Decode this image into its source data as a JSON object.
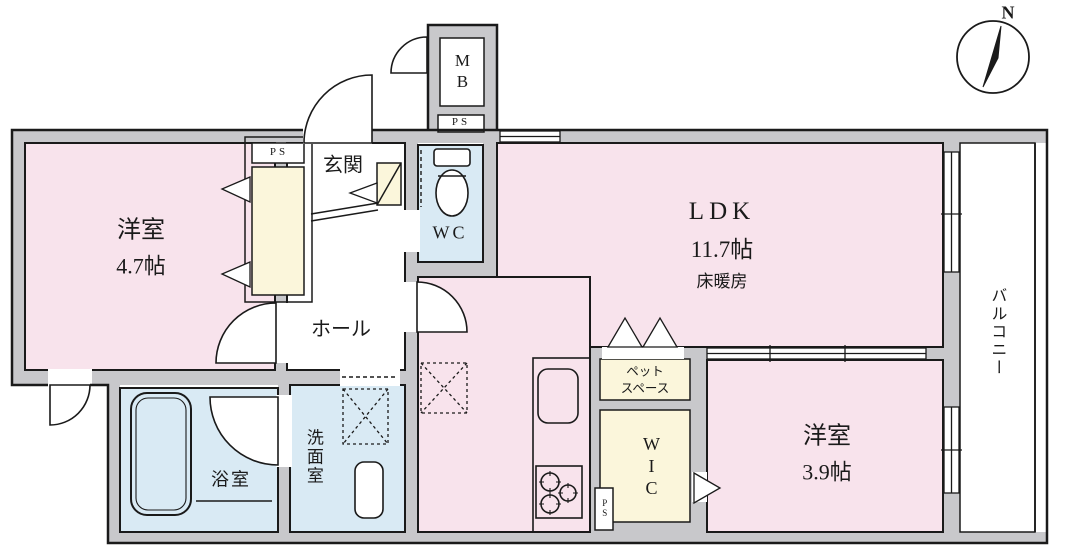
{
  "compass": {
    "north_label": "N"
  },
  "rooms": {
    "western_room_1": {
      "label": "洋室",
      "size": "4.7帖"
    },
    "entrance": {
      "label": "玄関"
    },
    "hall": {
      "label": "ホール"
    },
    "toilet": {
      "label": "WC"
    },
    "ldk": {
      "label": "LDK",
      "size": "11.7帖",
      "feature": "床暖房"
    },
    "bathroom": {
      "label": "浴室"
    },
    "washroom": {
      "label": "洗面室"
    },
    "walk_in_closet": {
      "label": "WIC"
    },
    "pet_space": {
      "lines": [
        "ペット",
        "スペース"
      ]
    },
    "western_room_2": {
      "label": "洋室",
      "size": "3.9帖"
    },
    "balcony": {
      "label": "バルコニー"
    }
  },
  "utility_labels": {
    "meter_box": "MB",
    "pipe_space": "PS"
  },
  "colors": {
    "room_pink": "#F8E3EC",
    "storage_cream": "#FBF6DB",
    "wet_area_blue": "#D9EAF4",
    "wall_gray": "#C8C8CB",
    "line": "#1A1A1A"
  }
}
